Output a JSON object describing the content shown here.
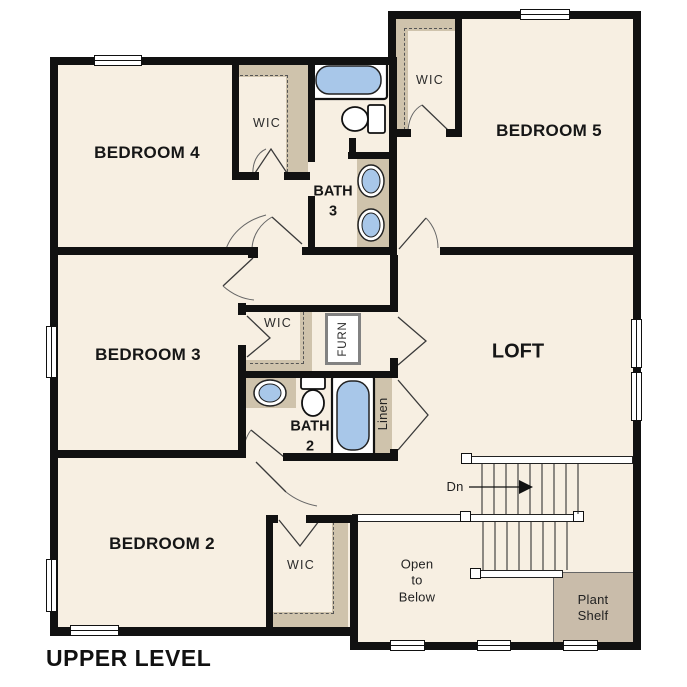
{
  "title": "UPPER LEVEL",
  "colors": {
    "floor": "#f7efe2",
    "closet": "#cfc3ac",
    "plant": "#c9bcaa",
    "blue": "#a8c7e9",
    "wall": "#111111"
  },
  "rooms": {
    "bedroom4": "BEDROOM 4",
    "bedroom5": "BEDROOM 5",
    "bedroom3": "BEDROOM 3",
    "bedroom2": "BEDROOM 2",
    "loft": "LOFT",
    "bath3_line1": "BATH",
    "bath3_line2": "3",
    "bath2_line1": "BATH",
    "bath2_line2": "2",
    "wic": "WIC",
    "furn": "FURN",
    "linen": "Linen",
    "stairs_down": "Dn",
    "open_below_line1": "Open",
    "open_below_line2": "to",
    "open_below_line3": "Below",
    "plant_shelf_line1": "Plant",
    "plant_shelf_line2": "Shelf"
  }
}
